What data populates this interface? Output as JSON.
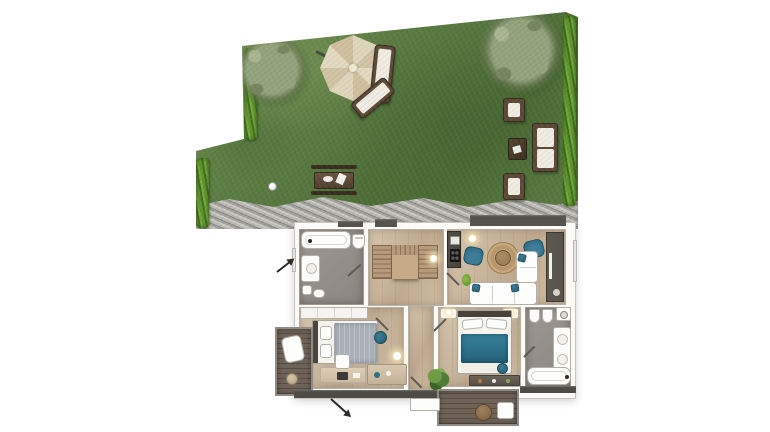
{
  "palette": {
    "grass": "#5b7d43",
    "grassDark": "#4c6c36",
    "grassLight": "#7e9c5f",
    "hedge": "#61942f",
    "hedgeDark": "#41701e",
    "gravel": "#a5a39e",
    "gravelDark": "#8a8883",
    "gravelLight": "#cbc9c4",
    "foliage": "#93a37d",
    "foliageDark": "#75865e",
    "foliageLight": "#a9b593",
    "parasol": "#e0d5bd",
    "parasolDark": "#d2c4a4",
    "outdoorWood": "#5c4937",
    "outdoorWoodDark": "#382c20",
    "cushion": "#f0ece2",
    "deck": "#6f6358",
    "deckEdge": "#8f8c86",
    "wall": "#fbfaf7",
    "wallLine": "#c9c5be",
    "floorWood": "#cfbca4",
    "floorWoodDark": "#c0ab91",
    "floorGray": "#9e9892",
    "floorGrayDark": "#8b8680",
    "counter": "#49453f",
    "mediaWall": "#57534d",
    "stairWood": "#b69a7b",
    "stairDark": "#8c7458",
    "landing": "#c6ab87",
    "teal": "#2e7089",
    "tealDark": "#235a6e",
    "blueGray": "#a9b0b9",
    "jute": "#c7a87b",
    "tableWood": "#97784f",
    "fixture": "#fdfdfb",
    "fixtureLine": "#b4b0a8",
    "plant": "#4f7c37",
    "windowDark": "#56534d",
    "glow": "#f6e4b0",
    "arrow": "#2d2a27"
  },
  "scene": {
    "type": "architectural-floor-plan-rendering",
    "garden": {
      "features": [
        "lawn",
        "gravel-path",
        "hedge-left-upper",
        "hedge-left-lower",
        "hedge-right",
        "tree-left",
        "tree-right",
        "cantilever-parasol",
        "sun-lounger",
        "sun-lounger",
        "picnic-table-with-benches",
        "football",
        "garden-armchair",
        "garden-armchair",
        "garden-coffee-table",
        "garden-sofa"
      ]
    },
    "floorplan": {
      "rooms": [
        "bathroom-top-left",
        "hall-with-staircase",
        "kitchen",
        "living-room",
        "bedroom-left",
        "corridor",
        "master-bedroom",
        "bathroom-right",
        "balcony-left",
        "terrace-bottom"
      ],
      "furniture": [
        "bathtub",
        "toilet",
        "washbasin",
        "staircase",
        "kitchen-counter",
        "round-rug",
        "coffee-table",
        "armchair",
        "armchair",
        "corner-sofa",
        "media-wall",
        "wardrobe",
        "bed",
        "desk",
        "desk-chair",
        "sideboard",
        "pouf",
        "floor-lamp",
        "double-bed",
        "nightstand",
        "nightstand",
        "dresser",
        "plant",
        "washing-machine",
        "toilet",
        "bidet",
        "double-washbasin",
        "bathtub",
        "lounge-chair",
        "outdoor-side-table",
        "entrance-arrow",
        "entrance-arrow"
      ]
    }
  }
}
